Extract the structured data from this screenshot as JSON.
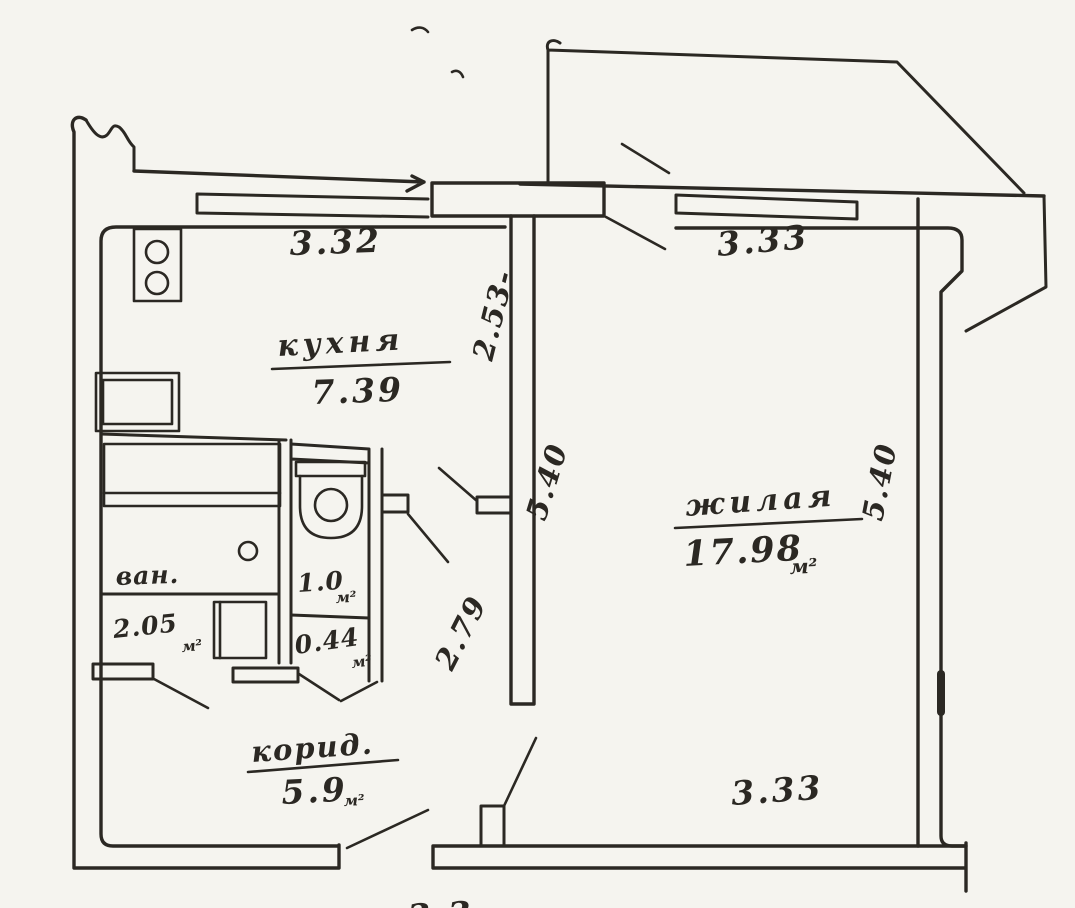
{
  "document": {
    "kind": "hand-drawn apartment floor plan scan",
    "paper_color": "#f5f4ef",
    "ink_color": "#2b2823"
  },
  "rooms": {
    "kitchen": {
      "label": "кухня",
      "area": "7.39"
    },
    "living": {
      "label": "жилая",
      "area": "17.98",
      "unit": "м²"
    },
    "bathroom": {
      "label": "ван.",
      "area": "2.05",
      "unit": "м²"
    },
    "wc": {
      "area": "1.0",
      "unit": "м²"
    },
    "closet": {
      "area": "0.44",
      "unit": "м²"
    },
    "corridor": {
      "label": "корид.",
      "area": "5.9",
      "unit": "м²"
    }
  },
  "dimensions": {
    "kitchen_width_top": "3.32",
    "living_width_top": "3.33",
    "kitchen_depth_left": "2.53-",
    "living_depth_inner": "5.40",
    "hall_depth_inner": "2.79",
    "living_depth_right": "5.40",
    "living_width_bottom": "3.33",
    "bottom_edge_partial": "3.3"
  },
  "fixtures": {
    "stove": "stove-icon",
    "kitchen_sink": "kitchen-sink-icon",
    "bathtub": "bathtub-icon",
    "bath_drain": "drain-icon",
    "washer": "washer-icon",
    "toilet": "toilet-icon"
  }
}
